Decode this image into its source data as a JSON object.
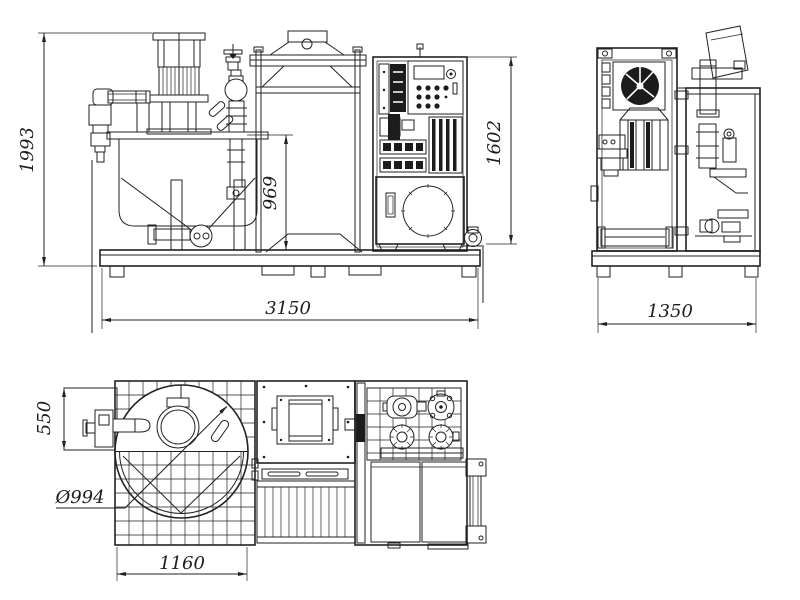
{
  "canvas": {
    "background": "#ffffff",
    "line_color": "#222222"
  },
  "views": {
    "front": {
      "dimensions": {
        "overall_height": "1993",
        "tank_height": "969",
        "cabinet_height": "1602",
        "overall_length": "3150"
      }
    },
    "side": {
      "dimensions": {
        "overall_width": "1350"
      }
    },
    "plan": {
      "dimensions": {
        "platform_depth": "550",
        "tank_diameter": "Ø994",
        "skid_length": "1160"
      }
    }
  }
}
